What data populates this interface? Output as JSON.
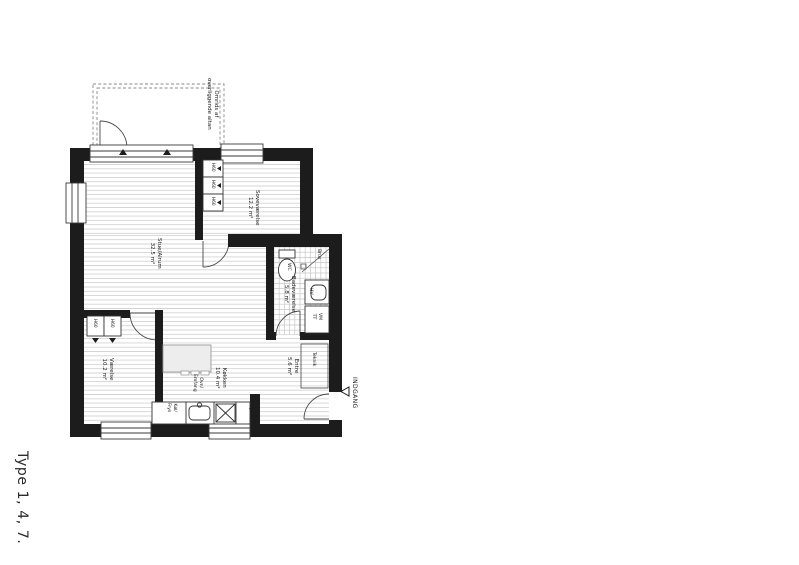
{
  "drawing_title": "Type 1, 4, 7.",
  "entrance_label": "INDGANG",
  "balcony_note": {
    "line1": "Omrids af",
    "line2": "overliggende altan"
  },
  "rooms": {
    "stue": {
      "name": "Stue/Alrum",
      "area": "32.5 m²"
    },
    "sove": {
      "name": "Soveværelse",
      "area": "12.2 m²"
    },
    "vaerelse": {
      "name": "Værelse",
      "area": "10.2 m²"
    },
    "koekken": {
      "name": "Køkken",
      "area": "10.4 m²"
    },
    "entre": {
      "name": "Entre",
      "area": "5.6 m²"
    },
    "bad": {
      "name": "Badeværelse",
      "area": "5.8 m²"
    },
    "teknik": {
      "name": "Teknik"
    }
  },
  "fixtures": {
    "wc": "WC",
    "shower": "Brus",
    "hand_basin": "HV",
    "washer": "VM",
    "dryer": "TT",
    "fridge_line1": "Køl/",
    "fridge_line2": "Frys",
    "oven_line1": "Ovn/",
    "oven_line2": "Emfang",
    "dishwasher": "Opv",
    "closet": "H60"
  },
  "colors": {
    "wall": "#1c1c1c",
    "floor_line": "#d4d4d4",
    "tile_line": "#c6c6c6"
  }
}
